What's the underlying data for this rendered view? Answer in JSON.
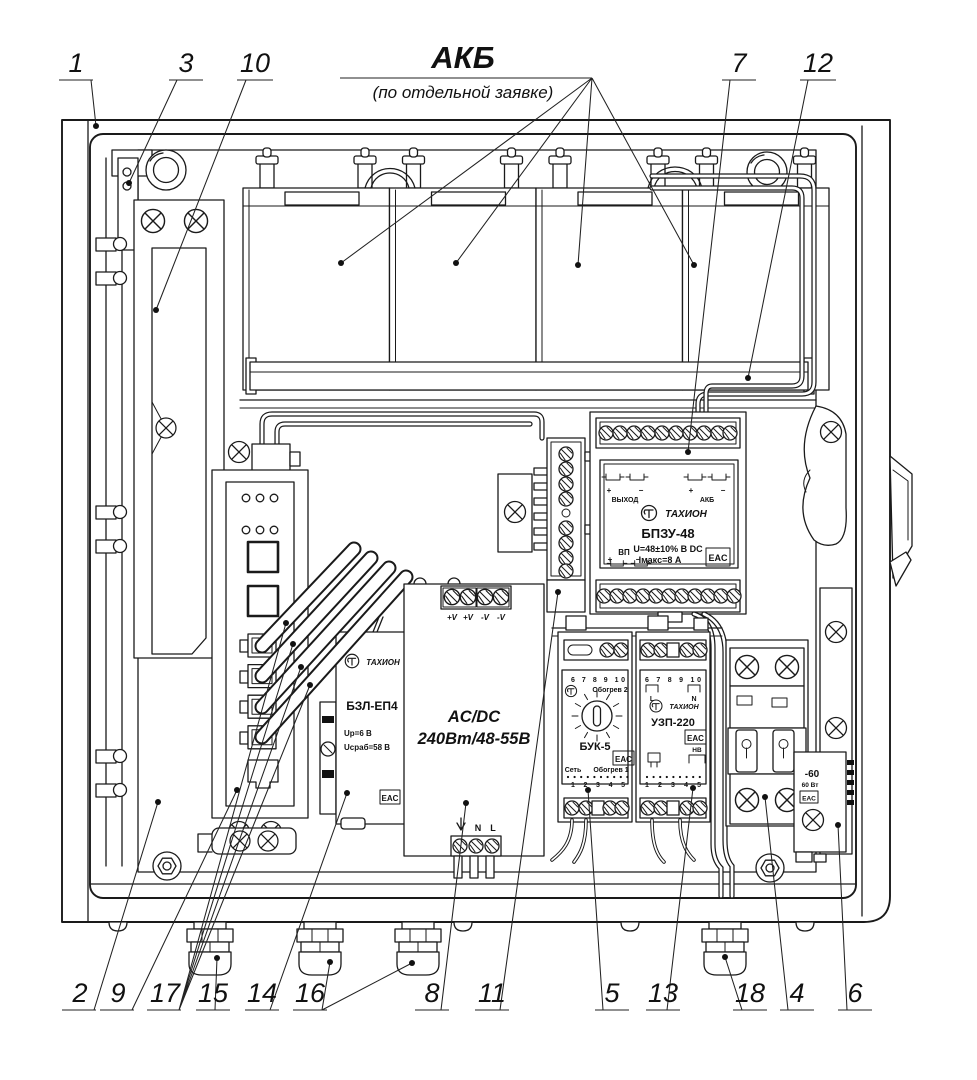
{
  "header": {
    "akb_label": "АКБ",
    "akb_note": "(по отдельной заявке)"
  },
  "callouts": {
    "c1": "1",
    "c2": "2",
    "c3": "3",
    "c4": "4",
    "c5": "5",
    "c6": "6",
    "c7": "7",
    "c8": "8",
    "c9": "9",
    "c10": "10",
    "c11": "11",
    "c12": "12",
    "c13": "13",
    "c14": "14",
    "c15": "15",
    "c16": "16",
    "c17": "17",
    "c18": "18"
  },
  "shared": {
    "eac": "EAC",
    "tahion": "ТАХИОН",
    "plus": "+",
    "minus": "−"
  },
  "modules": {
    "bpzu48": {
      "name": "БПЗУ-48",
      "u": "U=48±10% В DC",
      "imax": "Iмакс=8 А",
      "out": "ВЫХОД",
      "bat": "АКБ",
      "vp": "ВП"
    },
    "bzl_ep4": {
      "name": "БЗЛ-ЕП4",
      "u1": "Uр=6 В",
      "u2": "Uсраб=58 В"
    },
    "acdc": {
      "name": "AC/DC",
      "rating": "240Вт/48-55В",
      "vp": "+V",
      "vm": "-V",
      "n": "N",
      "l": "L"
    },
    "buk5": {
      "name": "БУК-5",
      "heat2": "Обогрев 2",
      "heat1": "Обогрев 1",
      "net": "Сеть",
      "top_terminals": "6  7  8  9  10",
      "bottom_terminals": "1  2  3  4  5"
    },
    "uzp220": {
      "name": "УЗП-220",
      "l": "L",
      "n": "N",
      "nv": "НВ",
      "top_terminals": "6  7  8  9  10",
      "bottom_terminals": "1  2  3  4  5"
    },
    "heater": {
      "label": "-60",
      "power": "60 Вт"
    }
  }
}
